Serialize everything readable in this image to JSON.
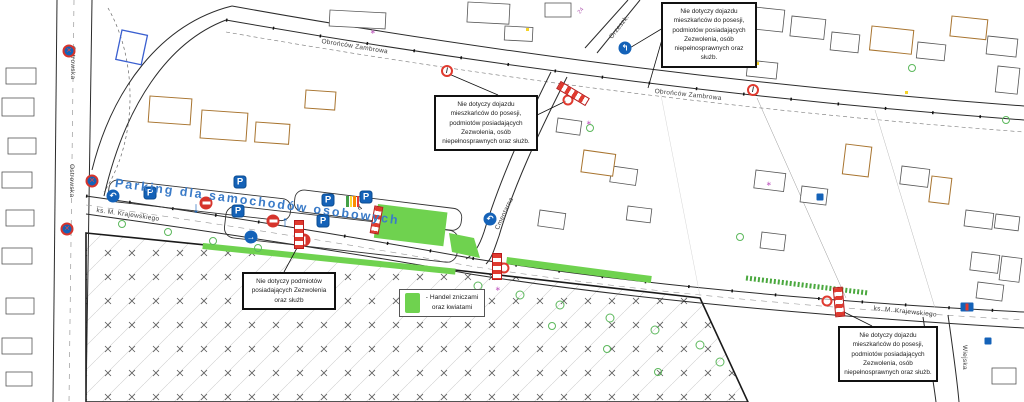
{
  "map_type": "traffic-organization-plan",
  "parking_title": "Parking dla samochodów osobowych",
  "streets": [
    {
      "id": "ostrowska-top",
      "label": "Ostrowska"
    },
    {
      "id": "ostrowska-bottom",
      "label": "Ostrowska"
    },
    {
      "id": "obroncow-zambrowa-left",
      "label": "Obrońców Zambrowa"
    },
    {
      "id": "obroncow-zambrowa-right",
      "label": "Obrońców Zambrowa"
    },
    {
      "id": "krajewskiego-left",
      "label": "ks. M. Krajewskiego"
    },
    {
      "id": "krajewskiego-right",
      "label": "ks. M. Krajewskiego"
    },
    {
      "id": "cmentarna",
      "label": "Cmentarna"
    },
    {
      "id": "orzeszkowej",
      "label": "Orzeszk."
    },
    {
      "id": "wiejska",
      "label": "Wiejska"
    }
  ],
  "callouts": [
    {
      "id": "top-right",
      "text": "Nie dotyczy dojazdu mieszkańców do posesji, podmiotów posiadających Zezwolenia, osób niepełnosprawnych oraz służb."
    },
    {
      "id": "mid-left",
      "text": "Nie dotyczy dojazdu mieszkańców do posesji, podmiotów posiadających Zezwolenia, osób niepełnosprawnych oraz służb."
    },
    {
      "id": "bottom-left",
      "text": "Nie dotyczy podmiotów posiadających Zezwolenia oraz służb"
    },
    {
      "id": "bottom-right",
      "text": "Nie dotyczy dojazdu mieszkańców do posesji, podmiotów posiadających Zezwolenia, osób niepełnosprawnych oraz służb."
    }
  ],
  "legend": {
    "text": "- Handel zniczami oraz kwiatami",
    "swatch_color": "#6fd24f"
  },
  "house_numbers": {
    "n24": "24"
  },
  "icons": {
    "parking_letter": "P",
    "wheelchair": "♿",
    "arrow_down": "↓",
    "arrow_up": "↑",
    "arrow_right": "→",
    "arrow_turn_left": "↶",
    "turn_split": "↰",
    "no_parking_mark": "/",
    "no_stop_x": "✕"
  },
  "colors": {
    "sign_blue": "#1462b8",
    "sign_red": "#d6342c",
    "green_area": "#6fd24f",
    "parking_text_blue": "#3a7bc8"
  }
}
